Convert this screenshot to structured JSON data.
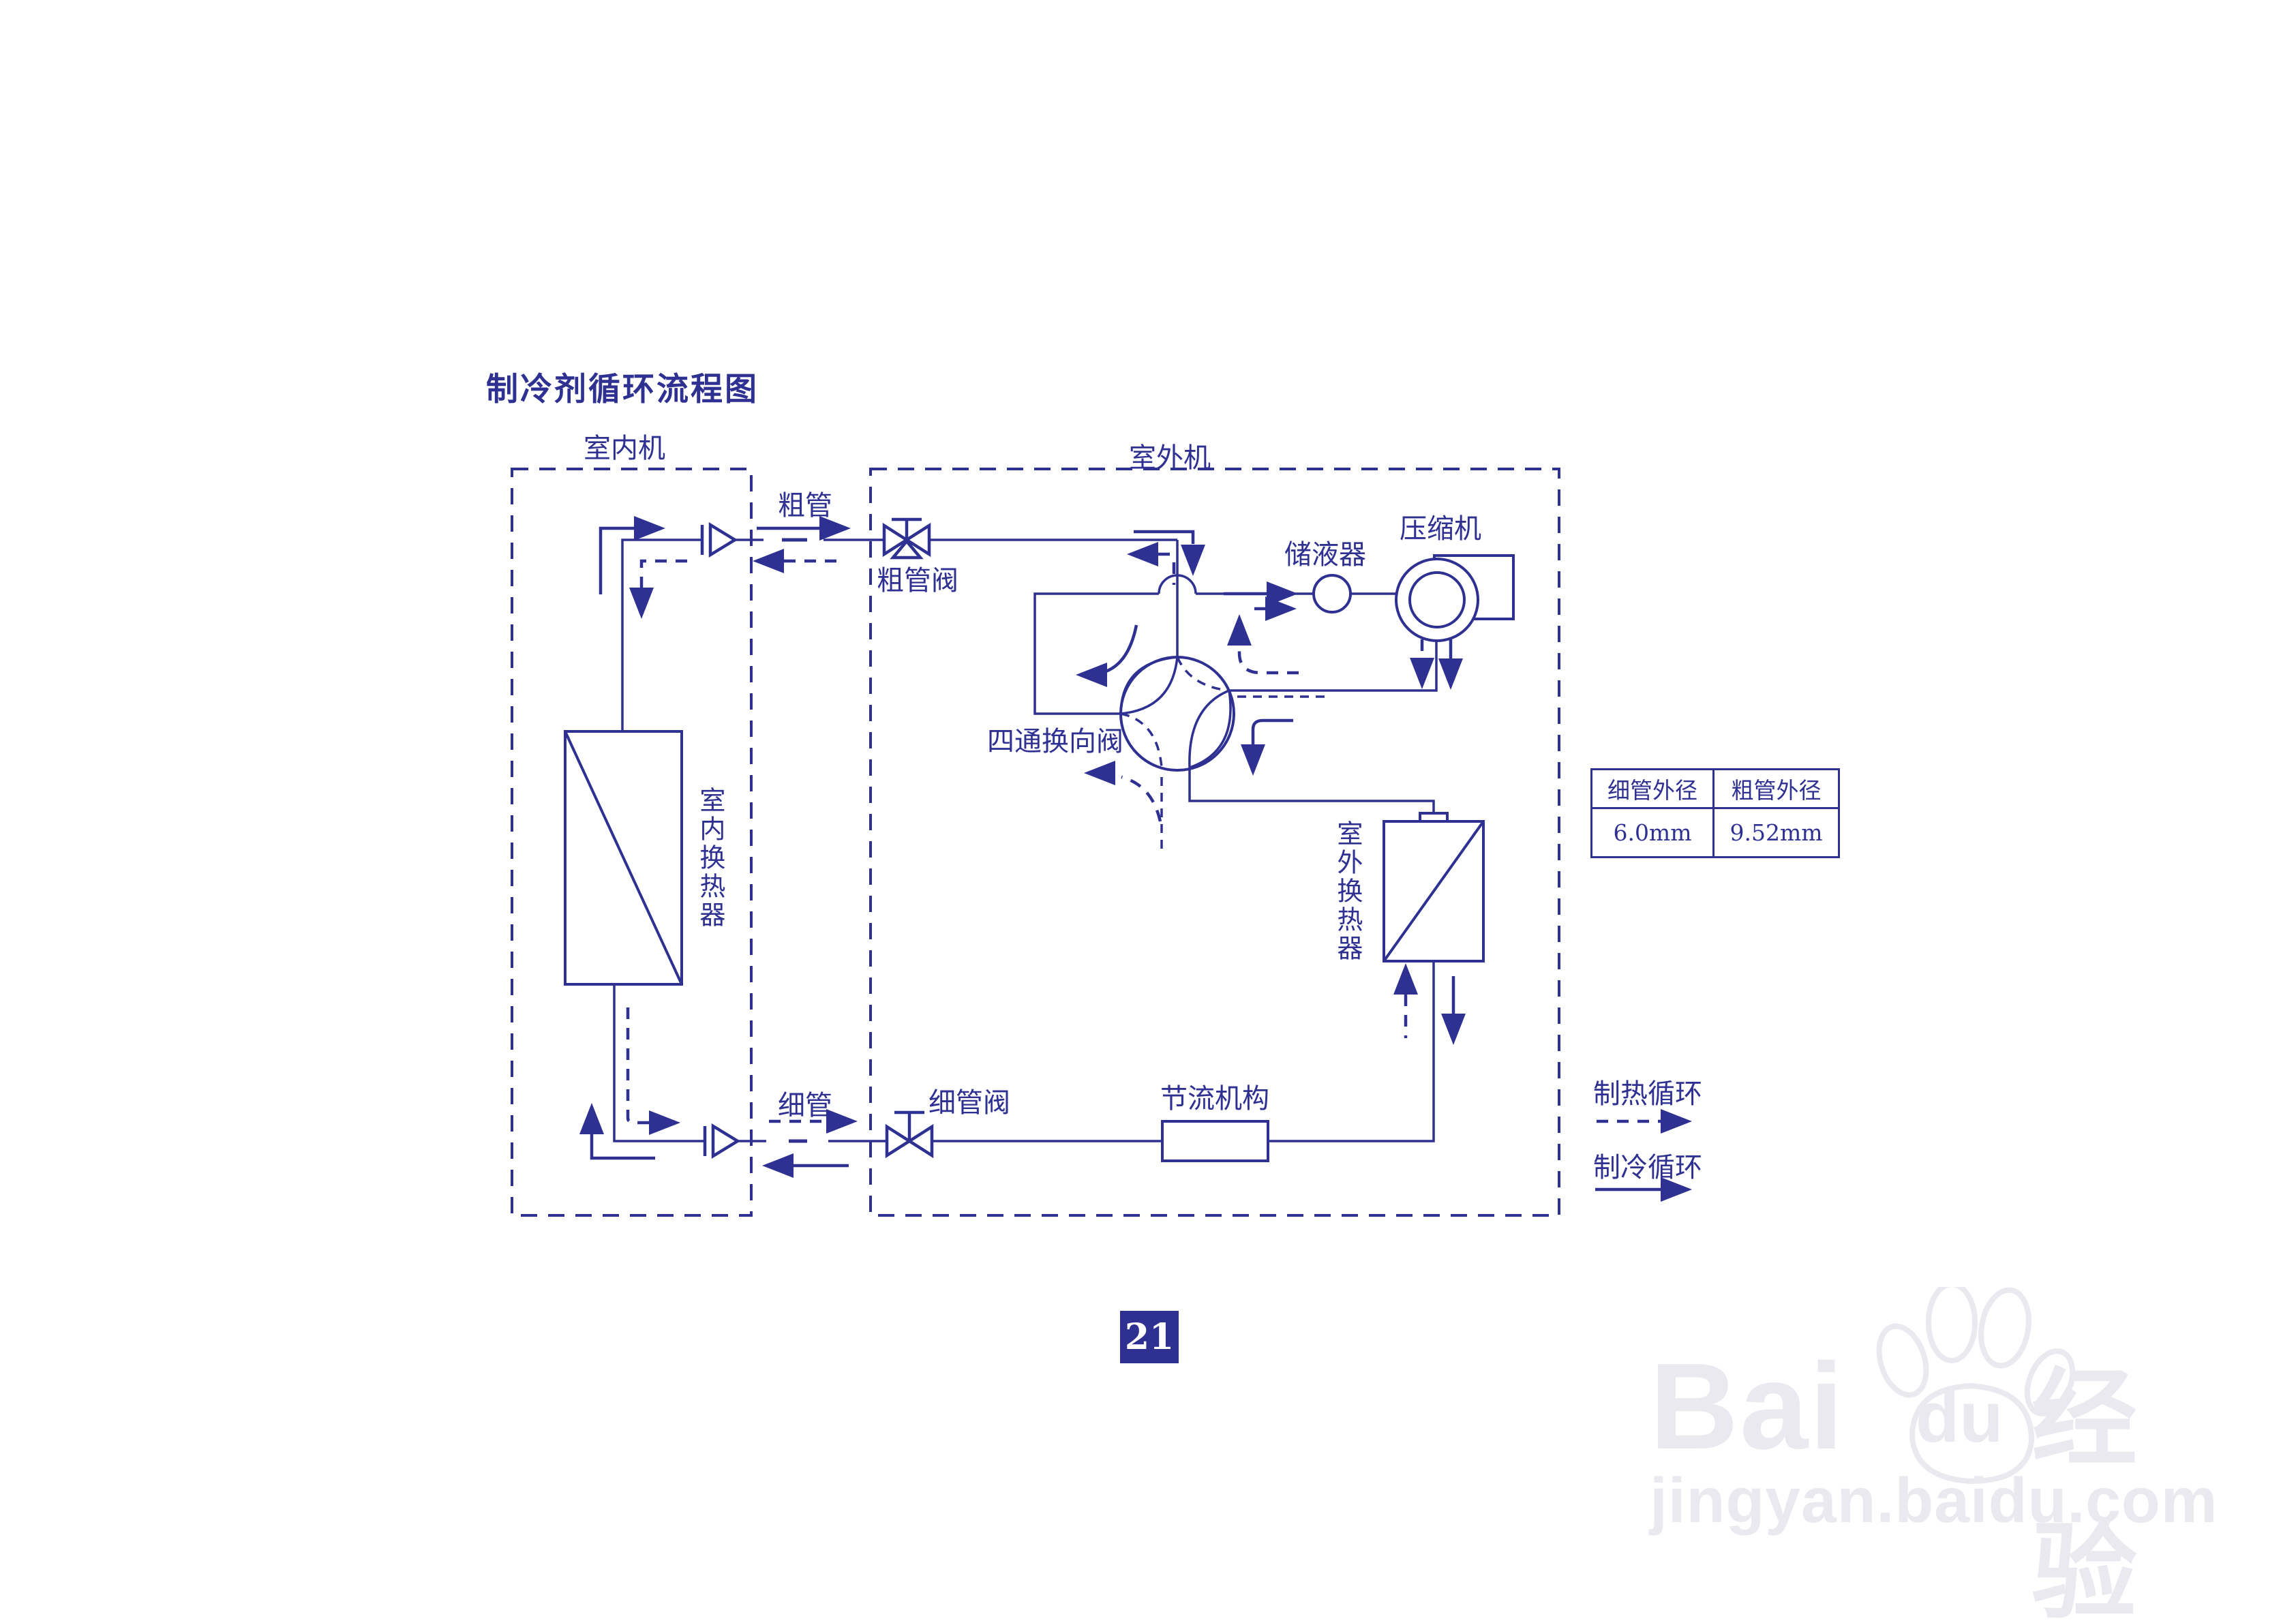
{
  "title": "制冷剂循环流程图",
  "page_number": "21",
  "diagram": {
    "indoor_unit_label": "室内机",
    "outdoor_unit_label": "室外机",
    "components": {
      "thick_pipe": "粗管",
      "thick_pipe_valve": "粗管阀",
      "accumulator": "储液器",
      "compressor": "压缩机",
      "four_way_valve": "四通换向阀",
      "indoor_heat_exchanger": "室内换热器",
      "outdoor_heat_exchanger": "室外换热器",
      "thin_pipe": "细管",
      "thin_pipe_valve": "细管阀",
      "throttle": "节流机构"
    },
    "legend": {
      "heating_label": "制热循环",
      "cooling_label": "制冷循环"
    }
  },
  "table": {
    "headers": [
      "细管外径",
      "粗管外径"
    ],
    "values": [
      "6.0mm",
      "9.52mm"
    ]
  },
  "watermark": {
    "brand_latin_1": "Bai",
    "brand_latin_2": "du",
    "brand_cjk": "经验",
    "site": "jingyan.baidu.com"
  },
  "colors": {
    "line": "#2e3192",
    "badge_background": "#2e3192",
    "watermark": "#e9e9ef",
    "background": "#ffffff"
  }
}
